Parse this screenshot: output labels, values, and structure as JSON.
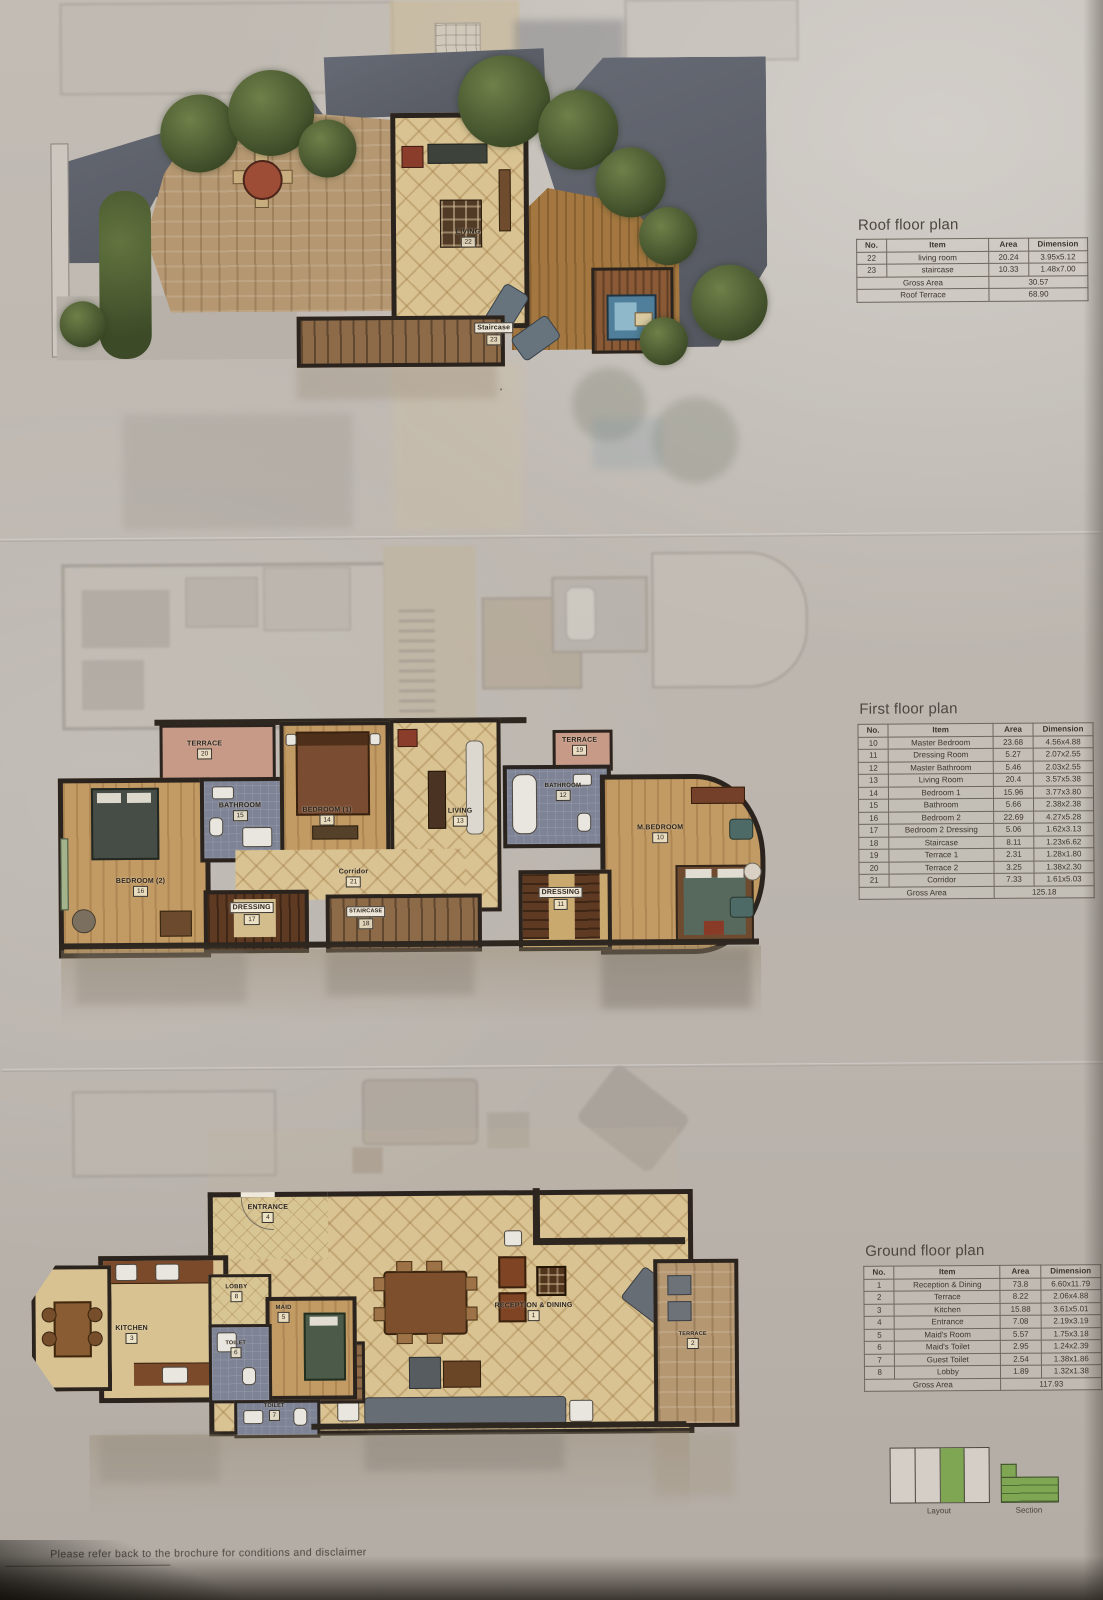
{
  "roof": {
    "title": "Roof floor plan",
    "table": {
      "headers": [
        "No.",
        "Item",
        "Area",
        "Dimension"
      ],
      "rows": [
        [
          "22",
          "living room",
          "20.24",
          "3.95x5.12"
        ],
        [
          "23",
          "staircase",
          "10.33",
          "1.48x7.00"
        ]
      ],
      "footers": [
        [
          "Gross Area",
          "30.57"
        ],
        [
          "Roof Terrace",
          "68.90"
        ]
      ]
    },
    "plan": {
      "living_label": "LIVING",
      "living_no": "22",
      "staircase_label": "Staircase",
      "staircase_no": "23"
    }
  },
  "first": {
    "title": "First floor plan",
    "table": {
      "headers": [
        "No.",
        "Item",
        "Area",
        "Dimension"
      ],
      "rows": [
        [
          "10",
          "Master Bedroom",
          "23.68",
          "4.56x4.88"
        ],
        [
          "11",
          "Dressing Room",
          "5.27",
          "2.07x2.55"
        ],
        [
          "12",
          "Master Bathroom",
          "5.46",
          "2.03x2.55"
        ],
        [
          "13",
          "Living Room",
          "20.4",
          "3.57x5.38"
        ],
        [
          "14",
          "Bedroom 1",
          "15.96",
          "3.77x3.80"
        ],
        [
          "15",
          "Bathroom",
          "5.66",
          "2.38x2.38"
        ],
        [
          "16",
          "Bedroom 2",
          "22.69",
          "4.27x5.28"
        ],
        [
          "17",
          "Bedroom 2 Dressing",
          "5.06",
          "1.62x3.13"
        ],
        [
          "18",
          "Staircase",
          "8.11",
          "1.23x6.62"
        ],
        [
          "19",
          "Terrace 1",
          "2.31",
          "1.28x1.80"
        ],
        [
          "20",
          "Terrace 2",
          "3.25",
          "1.38x2.30"
        ],
        [
          "21",
          "Corridor",
          "7.33",
          "1.61x5.03"
        ]
      ],
      "footers": [
        [
          "Gross Area",
          "125.18"
        ]
      ]
    },
    "plan": {
      "terrace_left_label": "TERRACE",
      "terrace_left_no": "20",
      "terrace_right_label": "TERRACE",
      "terrace_right_no": "19",
      "bathroom_left_label": "BATHROOM",
      "bathroom_left_no": "15",
      "bedroom1_label": "BEDROOM (1)",
      "bedroom1_no": "14",
      "bedroom2_label": "BEDROOM (2)",
      "bedroom2_no": "16",
      "dressing_left_label": "DRESSING",
      "dressing_left_no": "17",
      "corridor_label": "Corridor",
      "corridor_no": "21",
      "staircase_label": "STAIRCASE",
      "staircase_no": "18",
      "living_label": "LIVING",
      "living_no": "13",
      "bathroom_right_label": "BATHROOM",
      "bathroom_right_no": "12",
      "mbedroom_label": "M.BEDROOM",
      "mbedroom_no": "10",
      "dressing_right_label": "DRESSING",
      "dressing_right_no": "11"
    }
  },
  "ground": {
    "title": "Ground floor plan",
    "table": {
      "headers": [
        "No.",
        "Item",
        "Area",
        "Dimension"
      ],
      "rows": [
        [
          "1",
          "Reception & Dining",
          "73.8",
          "6.60x11.79"
        ],
        [
          "2",
          "Terrace",
          "8.22",
          "2.06x4.88"
        ],
        [
          "3",
          "Kitchen",
          "15.88",
          "3.61x5.01"
        ],
        [
          "4",
          "Entrance",
          "7.08",
          "2.19x3.19"
        ],
        [
          "5",
          "Maid's Room",
          "5.57",
          "1.75x3.18"
        ],
        [
          "6",
          "Maid's Toilet",
          "2.95",
          "1.24x2.39"
        ],
        [
          "7",
          "Guest Toilet",
          "2.54",
          "1.38x1.86"
        ],
        [
          "8",
          "Lobby",
          "1.89",
          "1.32x1.38"
        ]
      ],
      "footers": [
        [
          "Gross Area",
          "117.93"
        ]
      ]
    },
    "plan": {
      "entrance_label": "ENTRANCE",
      "entrance_no": "4",
      "lobby_label": "LOBBY",
      "lobby_no": "8",
      "maid_label": "MAID",
      "maid_no": "5",
      "kitchen_label": "KITCHEN",
      "kitchen_no": "3",
      "toilet_maid_label": "TOILET",
      "toilet_maid_no": "6",
      "toilet_guest_label": "TOILET",
      "toilet_guest_no": "7",
      "reception_label": "RECEPTION & DINING",
      "reception_no": "1",
      "terrace_label": "TERRACE",
      "terrace_no": "2"
    }
  },
  "legend": {
    "layout_label": "Layout",
    "section_label": "Section",
    "green": "#7fa653"
  },
  "footer": {
    "disclaimer": "Please refer back to the brochure for conditions and disclaimer"
  }
}
